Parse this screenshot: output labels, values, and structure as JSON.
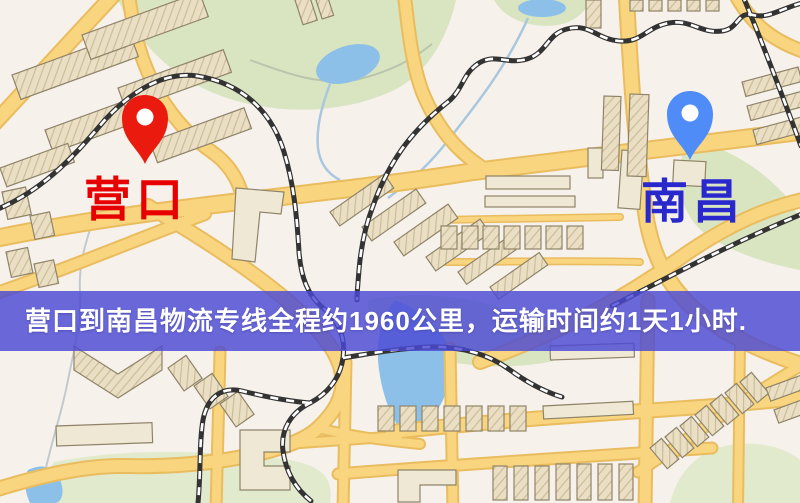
{
  "markers": {
    "origin": {
      "label": "营口",
      "label_color": "#e60000",
      "pin_color": "#ea1a0e",
      "pin_icon": "red-map-pin-icon"
    },
    "destination": {
      "label": "南昌",
      "label_color": "#2828cc",
      "pin_color": "#4f8cf7",
      "pin_icon": "blue-map-pin-icon"
    }
  },
  "banner": {
    "text": "营口到南昌物流专线全程约1960公里，运输时间约1天1小时.",
    "bg_color": "#4b49d4",
    "text_color": "#ffffff"
  },
  "map_palette": {
    "background": "#f7f1ec",
    "road_fill": "#f8d57e",
    "road_casing": "#e9bd5f",
    "park_green": "#d9e4c1",
    "water_blue": "#8cc0e8",
    "railway_dark": "#333333"
  }
}
